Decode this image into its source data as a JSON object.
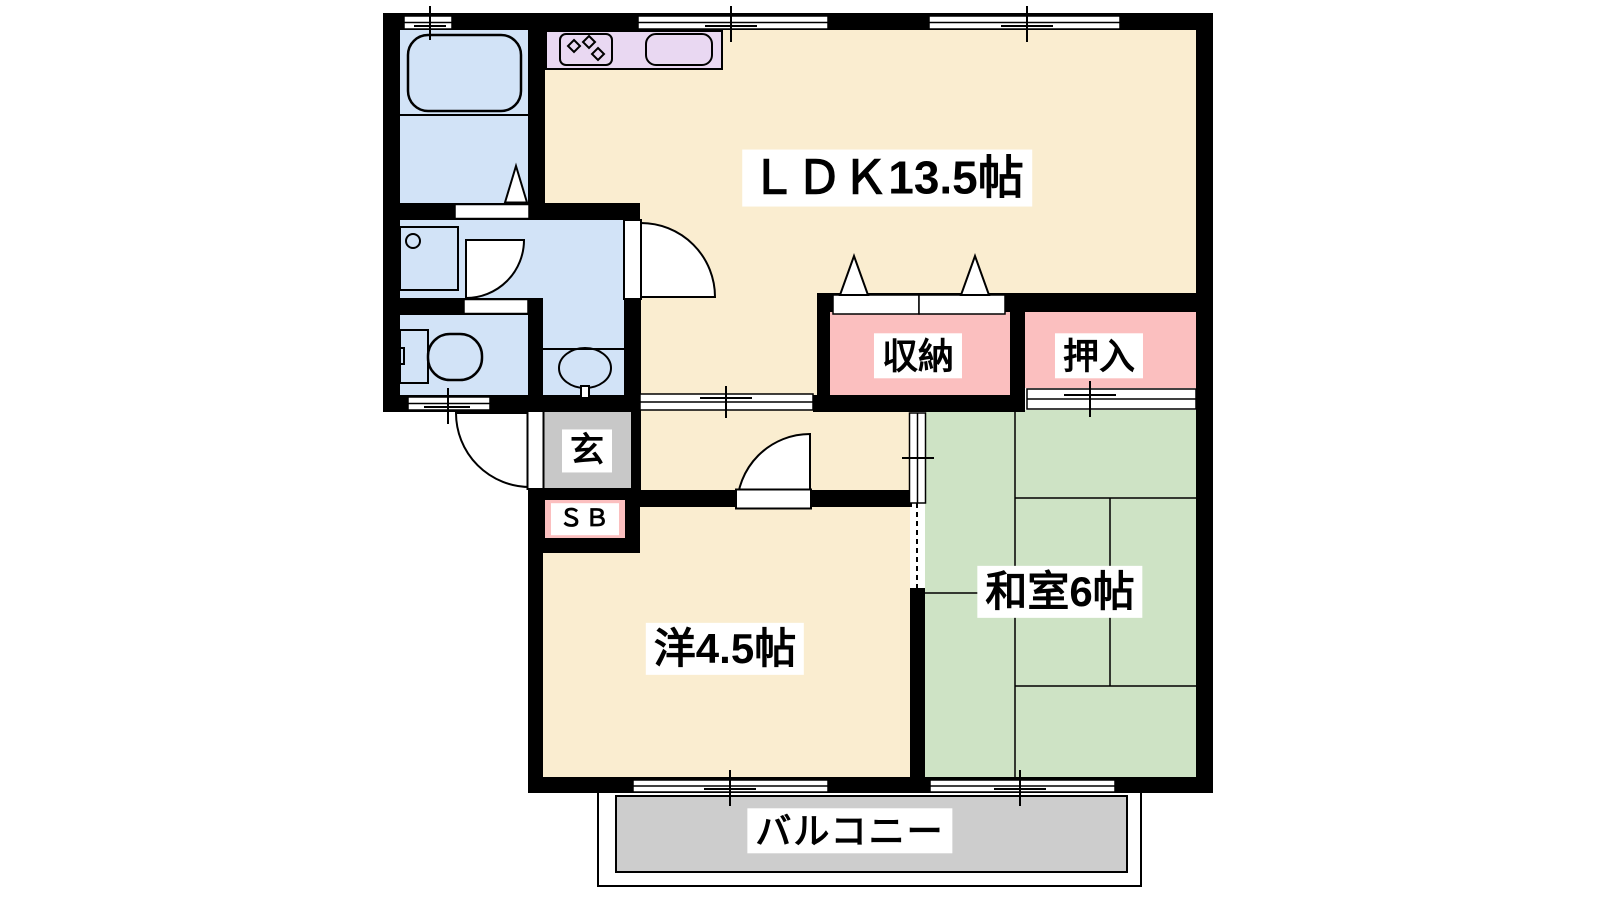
{
  "floorplan": {
    "labels": {
      "ldk": "ＬＤＫ13.5帖",
      "storage": "収納",
      "oshiire": "押入",
      "washitsu": "和室6帖",
      "western_room": "洋4.5帖",
      "entrance": "玄",
      "shoe_box": "ＳＢ",
      "balcony": "バルコニー"
    },
    "fixtures": [
      "bathtub-icon",
      "stove-burners-icon",
      "kitchen-sink-icon",
      "washbasin-icon",
      "toilet-icon",
      "vanity-sink-icon"
    ],
    "colors": {
      "room_cream": "#FAEDD0",
      "tatami_green": "#CEE3C5",
      "closet_pink": "#FBBFBF",
      "kitchen_lavender": "#E9D8F2",
      "wet_blue": "#D2E3F7",
      "entry_gray": "#C8C8C8",
      "balcony_gray": "#CDCDCD",
      "wall_black": "#000000",
      "label_bg": "#FFFFFF"
    }
  }
}
